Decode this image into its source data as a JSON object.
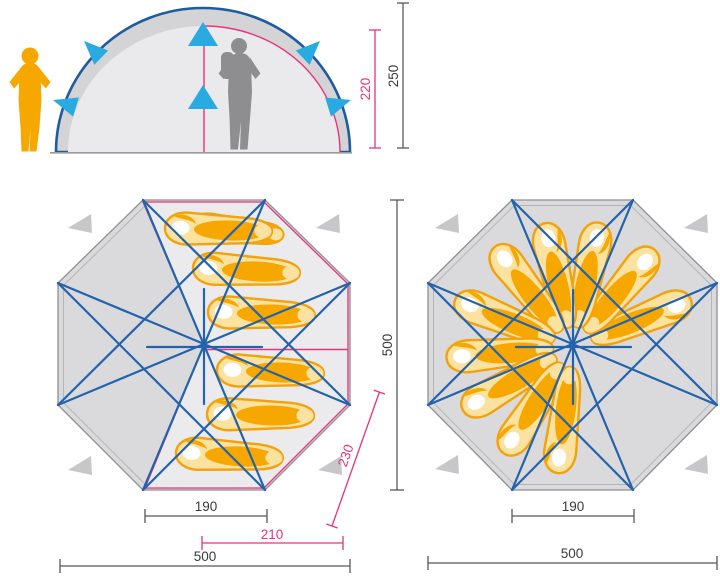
{
  "colors": {
    "pink": "#E8337E",
    "pole_blue": "#2463AC",
    "cyan": "#29ABE2",
    "orange": "#F7A800",
    "bag_light": "#FCE2A0",
    "gray_fill": "#DADADC",
    "gray_inner": "#EBEBED",
    "dim_dark": "#3A3A3C"
  },
  "elevation": {
    "inner_height": "220",
    "outer_height": "250"
  },
  "left_plan": {
    "inner_width": "190",
    "door_width": "210",
    "door_diagonal": "230",
    "overall_width": "500",
    "overall_depth": "500",
    "sleeping_bag_count": 6
  },
  "right_plan": {
    "inner_width": "190",
    "overall_width": "500",
    "sleeping_bag_count": 10
  }
}
